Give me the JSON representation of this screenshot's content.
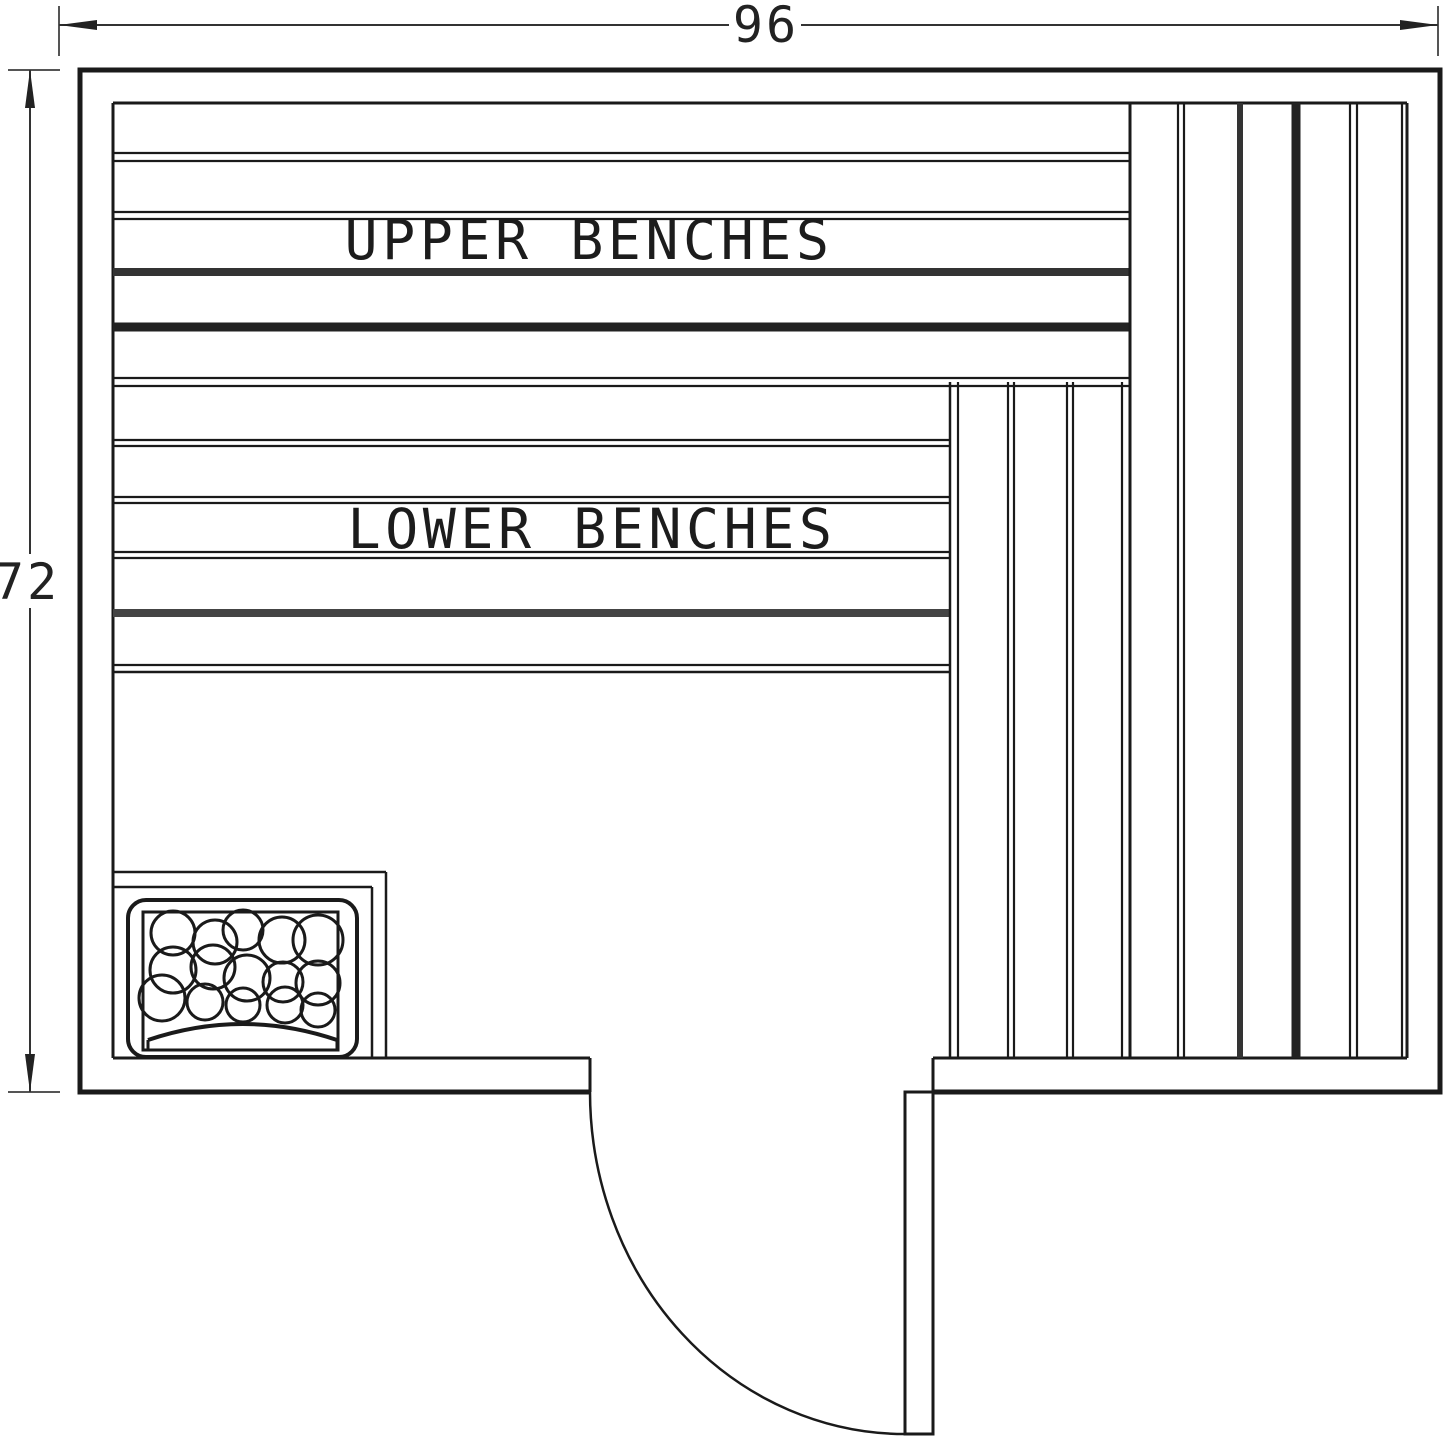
{
  "plan": {
    "title": "Sauna layout floor plan",
    "canvas": {
      "width": 1445,
      "height": 1445
    },
    "colors": {
      "background": "#ffffff",
      "line": "#1a1a1a",
      "wall": "#000000",
      "thick_plank_dark": "#222222",
      "thick_plank": "#333333",
      "thick_plank_gray": "#444444",
      "dimension": "#333333",
      "extension": "#555555"
    },
    "dimensions": {
      "width": {
        "value": "96"
      },
      "height": {
        "value": "72"
      }
    },
    "labels": {
      "upper_benches": "UPPER BENCHES",
      "lower_benches": "LOWER BENCHES"
    },
    "geometry": {
      "defaults": {
        "stroke": "#1a1a1a",
        "width": 2.2,
        "arrow": "#222222"
      },
      "groups": [
        {
          "name": "wall-outline",
          "paths": [
            {
              "d": "M590,1092 L80,1092 L80,70 L1440,70 L1440,1092 L933,1092",
              "w": 5
            }
          ],
          "lines": [
            {
              "x1": 113,
              "y1": 103,
              "x2": 113,
              "y2": 1058,
              "w": 3
            },
            {
              "x1": 113,
              "y1": 103,
              "x2": 1407,
              "y2": 103,
              "w": 3
            },
            {
              "x1": 1407,
              "y1": 103,
              "x2": 1407,
              "y2": 1058,
              "w": 3
            },
            {
              "x1": 113,
              "y1": 1058,
              "x2": 590,
              "y2": 1058,
              "w": 3
            },
            {
              "x1": 933,
              "y1": 1058,
              "x2": 1407,
              "y2": 1058,
              "w": 3
            },
            {
              "x1": 590,
              "y1": 1058,
              "x2": 590,
              "y2": 1092,
              "w": 3
            },
            {
              "x1": 933,
              "y1": 1058,
              "x2": 933,
              "y2": 1092,
              "w": 3
            }
          ]
        },
        {
          "name": "upper-bench-planks",
          "lines": [
            {
              "x1": 113,
              "y1": 153,
              "x2": 1130,
              "y2": 153
            },
            {
              "x1": 113,
              "y1": 161,
              "x2": 1130,
              "y2": 161
            },
            {
              "x1": 113,
              "y1": 212,
              "x2": 1130,
              "y2": 212
            },
            {
              "x1": 113,
              "y1": 219,
              "x2": 1130,
              "y2": 219
            },
            {
              "x1": 113,
              "y1": 272,
              "x2": 1130,
              "y2": 272,
              "w": 8,
              "c": "#333333"
            },
            {
              "x1": 113,
              "y1": 327,
              "x2": 1130,
              "y2": 327,
              "w": 9,
              "c": "#222222"
            },
            {
              "x1": 113,
              "y1": 378,
              "x2": 1130,
              "y2": 378
            },
            {
              "x1": 113,
              "y1": 386,
              "x2": 1130,
              "y2": 386
            }
          ]
        },
        {
          "name": "lower-bench-planks",
          "lines": [
            {
              "x1": 113,
              "y1": 440,
              "x2": 950,
              "y2": 440
            },
            {
              "x1": 113,
              "y1": 446,
              "x2": 950,
              "y2": 446
            },
            {
              "x1": 113,
              "y1": 497,
              "x2": 950,
              "y2": 497
            },
            {
              "x1": 113,
              "y1": 503,
              "x2": 950,
              "y2": 503
            },
            {
              "x1": 113,
              "y1": 552,
              "x2": 950,
              "y2": 552
            },
            {
              "x1": 113,
              "y1": 558,
              "x2": 950,
              "y2": 558
            },
            {
              "x1": 113,
              "y1": 613,
              "x2": 950,
              "y2": 613,
              "w": 8,
              "c": "#444444"
            },
            {
              "x1": 113,
              "y1": 665,
              "x2": 950,
              "y2": 665
            },
            {
              "x1": 113,
              "y1": 672,
              "x2": 950,
              "y2": 672,
              "w": 2.5
            }
          ]
        },
        {
          "name": "corner-vertical-planks",
          "lines": [
            {
              "x1": 950,
              "y1": 382,
              "x2": 950,
              "y2": 1058,
              "w": 2.5
            },
            {
              "x1": 958,
              "y1": 382,
              "x2": 958,
              "y2": 1058
            },
            {
              "x1": 1008,
              "y1": 382,
              "x2": 1008,
              "y2": 1058
            },
            {
              "x1": 1014,
              "y1": 382,
              "x2": 1014,
              "y2": 1058
            },
            {
              "x1": 1067,
              "y1": 382,
              "x2": 1067,
              "y2": 1058
            },
            {
              "x1": 1073,
              "y1": 382,
              "x2": 1073,
              "y2": 1058
            },
            {
              "x1": 1122,
              "y1": 382,
              "x2": 1122,
              "y2": 1058
            }
          ]
        },
        {
          "name": "right-vertical-planks",
          "lines": [
            {
              "x1": 1130,
              "y1": 103,
              "x2": 1130,
              "y2": 1058,
              "w": 3
            },
            {
              "x1": 1178,
              "y1": 103,
              "x2": 1178,
              "y2": 1058
            },
            {
              "x1": 1184,
              "y1": 103,
              "x2": 1184,
              "y2": 1058
            },
            {
              "x1": 1240,
              "y1": 103,
              "x2": 1240,
              "y2": 1058,
              "w": 6,
              "c": "#333333"
            },
            {
              "x1": 1296,
              "y1": 103,
              "x2": 1296,
              "y2": 1058,
              "w": 9,
              "c": "#222222"
            },
            {
              "x1": 1350,
              "y1": 103,
              "x2": 1350,
              "y2": 1058
            },
            {
              "x1": 1357,
              "y1": 103,
              "x2": 1357,
              "y2": 1058
            },
            {
              "x1": 1402,
              "y1": 103,
              "x2": 1402,
              "y2": 1058
            }
          ]
        },
        {
          "name": "heater",
          "lines": [
            {
              "x1": 113,
              "y1": 872,
              "x2": 386,
              "y2": 872,
              "w": 2.5
            },
            {
              "x1": 113,
              "y1": 887,
              "x2": 372,
              "y2": 887,
              "w": 2.5
            },
            {
              "x1": 372,
              "y1": 887,
              "x2": 372,
              "y2": 1058,
              "w": 2.5
            },
            {
              "x1": 386,
              "y1": 872,
              "x2": 386,
              "y2": 1058,
              "w": 2.5
            }
          ],
          "rects": [
            {
              "x": 128,
              "y": 900,
              "w": 229,
              "h": 157,
              "rx": 18,
              "sw": 4
            },
            {
              "x": 143,
              "y": 912,
              "w": 195,
              "h": 138,
              "sw": 3
            }
          ],
          "circles": [
            {
              "cx": 173,
              "cy": 933,
              "r": 22
            },
            {
              "cx": 215,
              "cy": 942,
              "r": 22
            },
            {
              "cx": 243,
              "cy": 930,
              "r": 20
            },
            {
              "cx": 282,
              "cy": 940,
              "r": 23
            },
            {
              "cx": 318,
              "cy": 940,
              "r": 25
            },
            {
              "cx": 173,
              "cy": 970,
              "r": 23
            },
            {
              "cx": 213,
              "cy": 967,
              "r": 22
            },
            {
              "cx": 247,
              "cy": 978,
              "r": 23
            },
            {
              "cx": 283,
              "cy": 982,
              "r": 20
            },
            {
              "cx": 318,
              "cy": 983,
              "r": 22
            },
            {
              "cx": 162,
              "cy": 998,
              "r": 23
            },
            {
              "cx": 205,
              "cy": 1002,
              "r": 18
            },
            {
              "cx": 243,
              "cy": 1005,
              "r": 17
            },
            {
              "cx": 285,
              "cy": 1005,
              "r": 18
            },
            {
              "cx": 318,
              "cy": 1010,
              "r": 17
            }
          ],
          "paths": [
            {
              "d": "M148,1040 Q243,1008 337,1040",
              "w": 4
            },
            {
              "d": "M148,1040 L148,1050",
              "w": 3
            },
            {
              "d": "M337,1040 L337,1050",
              "w": 3
            }
          ]
        },
        {
          "name": "door",
          "rects": [
            {
              "x": 905,
              "y": 1092,
              "w": 28,
              "h": 342,
              "sw": 3
            }
          ],
          "paths": [
            {
              "d": "M590,1092 A315,342 0 0 0 905,1434",
              "w": 2.5
            }
          ]
        },
        {
          "name": "dimension-top",
          "lines": [
            {
              "x1": 59,
              "y1": 6,
              "x2": 59,
              "y2": 56,
              "c": "#555555",
              "w": 2
            },
            {
              "x1": 1438,
              "y1": 6,
              "x2": 1438,
              "y2": 56,
              "c": "#555555",
              "w": 2
            },
            {
              "x1": 59,
              "y1": 25,
              "x2": 729,
              "y2": 25,
              "c": "#333333",
              "w": 2
            },
            {
              "x1": 801,
              "y1": 25,
              "x2": 1438,
              "y2": 25,
              "c": "#333333",
              "w": 2
            }
          ],
          "polygons": [
            {
              "points": "59,25 97,20 97,30"
            },
            {
              "points": "1438,25 1400,20 1400,30"
            }
          ]
        },
        {
          "name": "dimension-left",
          "lines": [
            {
              "x1": 8,
              "y1": 70,
              "x2": 60,
              "y2": 70,
              "c": "#555555",
              "w": 2
            },
            {
              "x1": 8,
              "y1": 1092,
              "x2": 60,
              "y2": 1092,
              "c": "#555555",
              "w": 2
            },
            {
              "x1": 30,
              "y1": 70,
              "x2": 30,
              "y2": 554,
              "c": "#333333",
              "w": 2
            },
            {
              "x1": 30,
              "y1": 608,
              "x2": 30,
              "y2": 1092,
              "c": "#333333",
              "w": 2
            }
          ],
          "polygons": [
            {
              "points": "30,70 25,108 35,108"
            },
            {
              "points": "30,1092 25,1054 35,1054"
            }
          ]
        }
      ]
    }
  }
}
